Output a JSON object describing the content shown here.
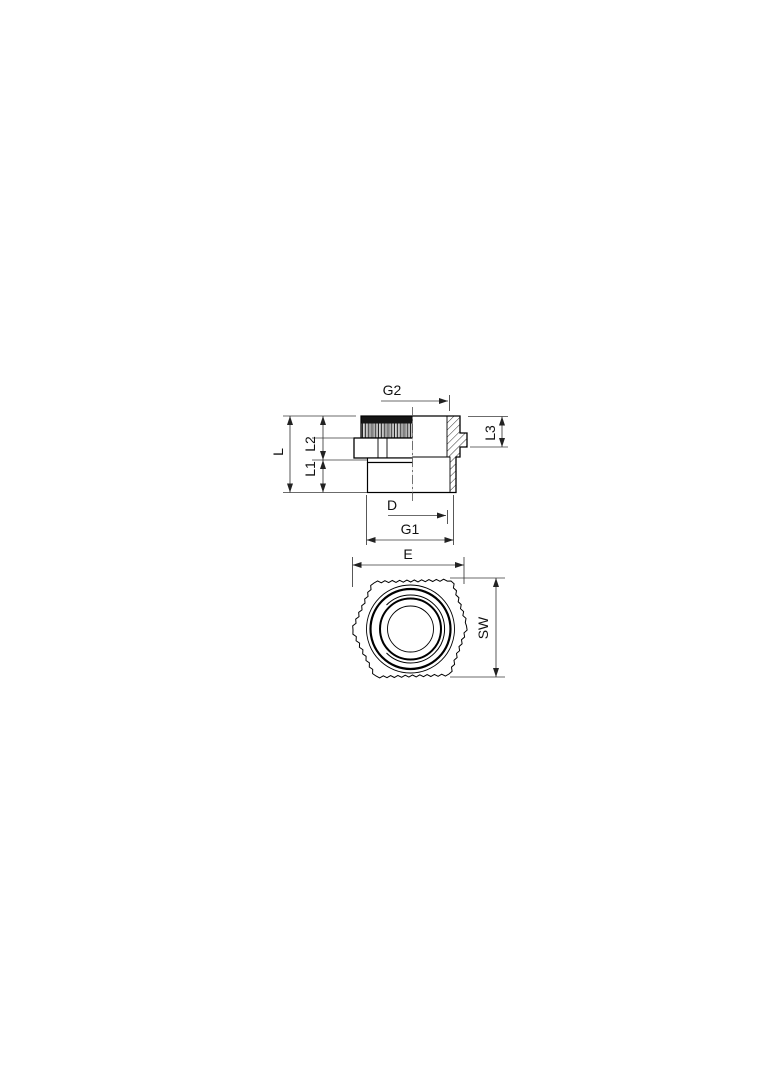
{
  "page": {
    "background": "#ffffff"
  },
  "drawing": {
    "type": "technical-dimension-drawing",
    "description": "Sectioned side view and bottom view of a threaded hexagonal adapter gland with dimension callouts",
    "views": {
      "side": {
        "name": "side-section-view",
        "dimension_labels": [
          "G2",
          "L",
          "L2",
          "L1",
          "L3",
          "D",
          "G1"
        ]
      },
      "bottom": {
        "name": "bottom-hex-view",
        "dimension_labels": [
          "E",
          "SW"
        ]
      }
    },
    "labels": {
      "g2": "G2",
      "l": "L",
      "l2": "L2",
      "l1": "L1",
      "l3": "L3",
      "d": "D",
      "g1": "G1",
      "e": "E",
      "sw": "SW"
    },
    "colors": {
      "part_line": "#000000",
      "dimension_line": "#3a3a3a",
      "text": "#111111",
      "background": "#ffffff"
    }
  }
}
